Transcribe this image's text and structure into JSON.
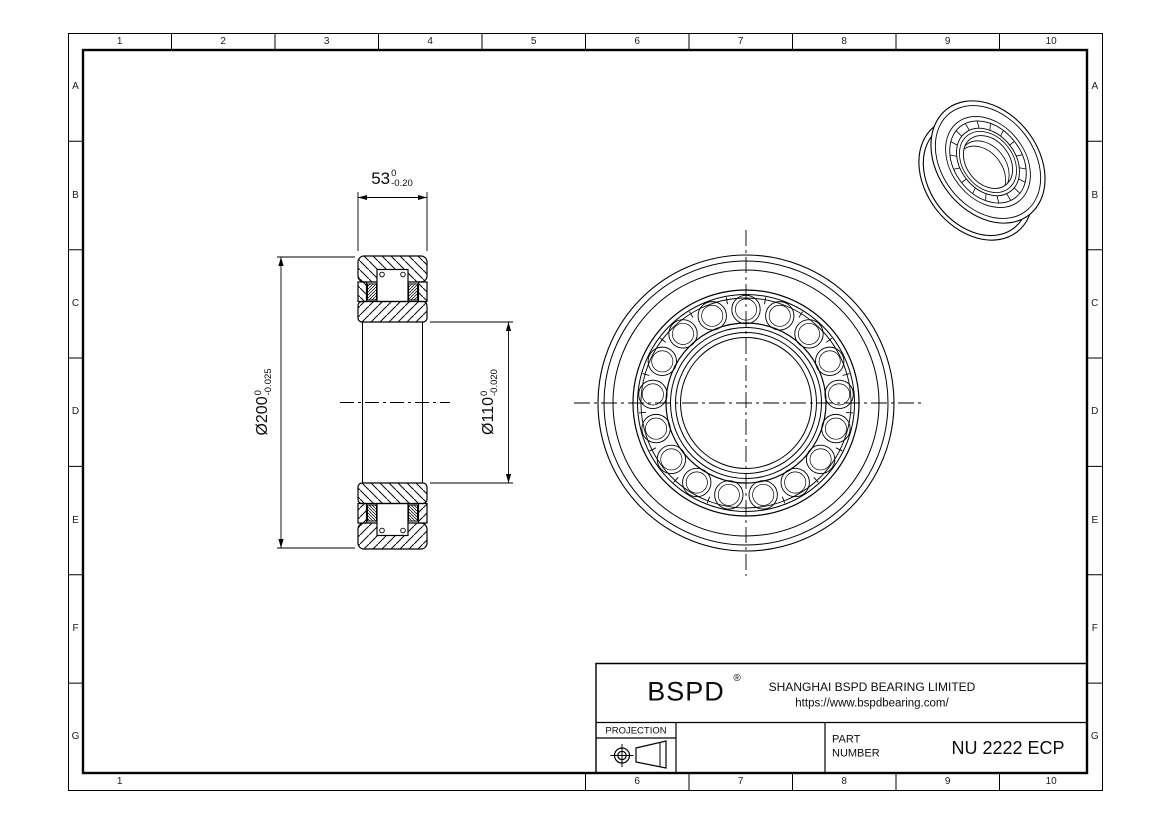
{
  "grid": {
    "top": [
      "1",
      "2",
      "3",
      "4",
      "5",
      "6",
      "7",
      "8",
      "9",
      "10"
    ],
    "bottom": [
      "1",
      "6",
      "7",
      "8",
      "9",
      "10"
    ],
    "left": [
      "A",
      "B",
      "C",
      "D",
      "E",
      "F",
      "G"
    ],
    "right": [
      "A",
      "B",
      "C",
      "D",
      "E",
      "F",
      "G"
    ]
  },
  "dimensions": {
    "width": {
      "value": "53",
      "tol_upper": "0",
      "tol_lower": "-0.20"
    },
    "outer_diameter": {
      "value": "Ø200",
      "tol_upper": "0",
      "tol_lower": "-0.025"
    },
    "bore_diameter": {
      "value": "Ø110",
      "tol_upper": "0",
      "tol_lower": "-0.020"
    }
  },
  "title_block": {
    "brand": "BSPD",
    "registered": "®",
    "company": "SHANGHAI BSPD BEARING LIMITED",
    "website": "https://www.bspdbearing.com/",
    "projection_label": "PROJECTION",
    "part_label_line1": "PART",
    "part_label_line2": "NUMBER",
    "part_number": "NU 2222 ECP"
  },
  "colors": {
    "line": "#000000",
    "background": "#ffffff"
  }
}
